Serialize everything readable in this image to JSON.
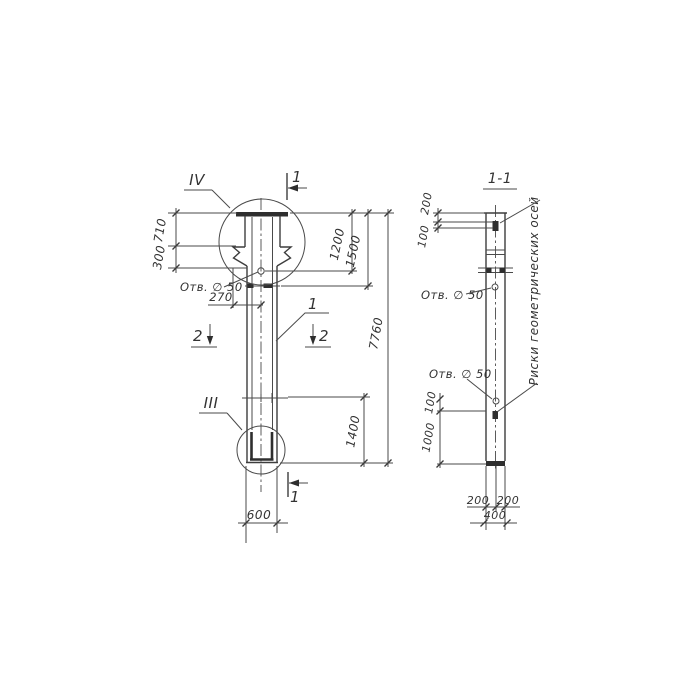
{
  "drawing": {
    "type": "structural column elevation with section",
    "ink_color": "#3d3d3d",
    "paper_color": "#ffffff"
  },
  "left_view": {
    "marker_iv": "IV",
    "marker_iii": "III",
    "marker_1": "1",
    "marker_2_left": "2",
    "marker_2_right": "2",
    "shaft_label": "1",
    "hole_label": "Отв. ∅ 50",
    "dim_710": "710",
    "dim_300": "300",
    "dim_270": "270",
    "dim_1200": "1200",
    "dim_1500": "1500",
    "dim_7760": "7760",
    "dim_1400": "1400",
    "dim_600": "600"
  },
  "section_view": {
    "title": "1-1",
    "hole_label_top": "Отв. ∅ 50",
    "hole_label_bottom": "Отв. ∅ 50",
    "axis_label": "Риски геометрических осей",
    "dim_200_top": "200",
    "dim_100_top": "100",
    "dim_100_mid": "100",
    "dim_1000": "1000",
    "dim_200_bl": "200",
    "dim_200_br": "200",
    "dim_400": "400"
  }
}
